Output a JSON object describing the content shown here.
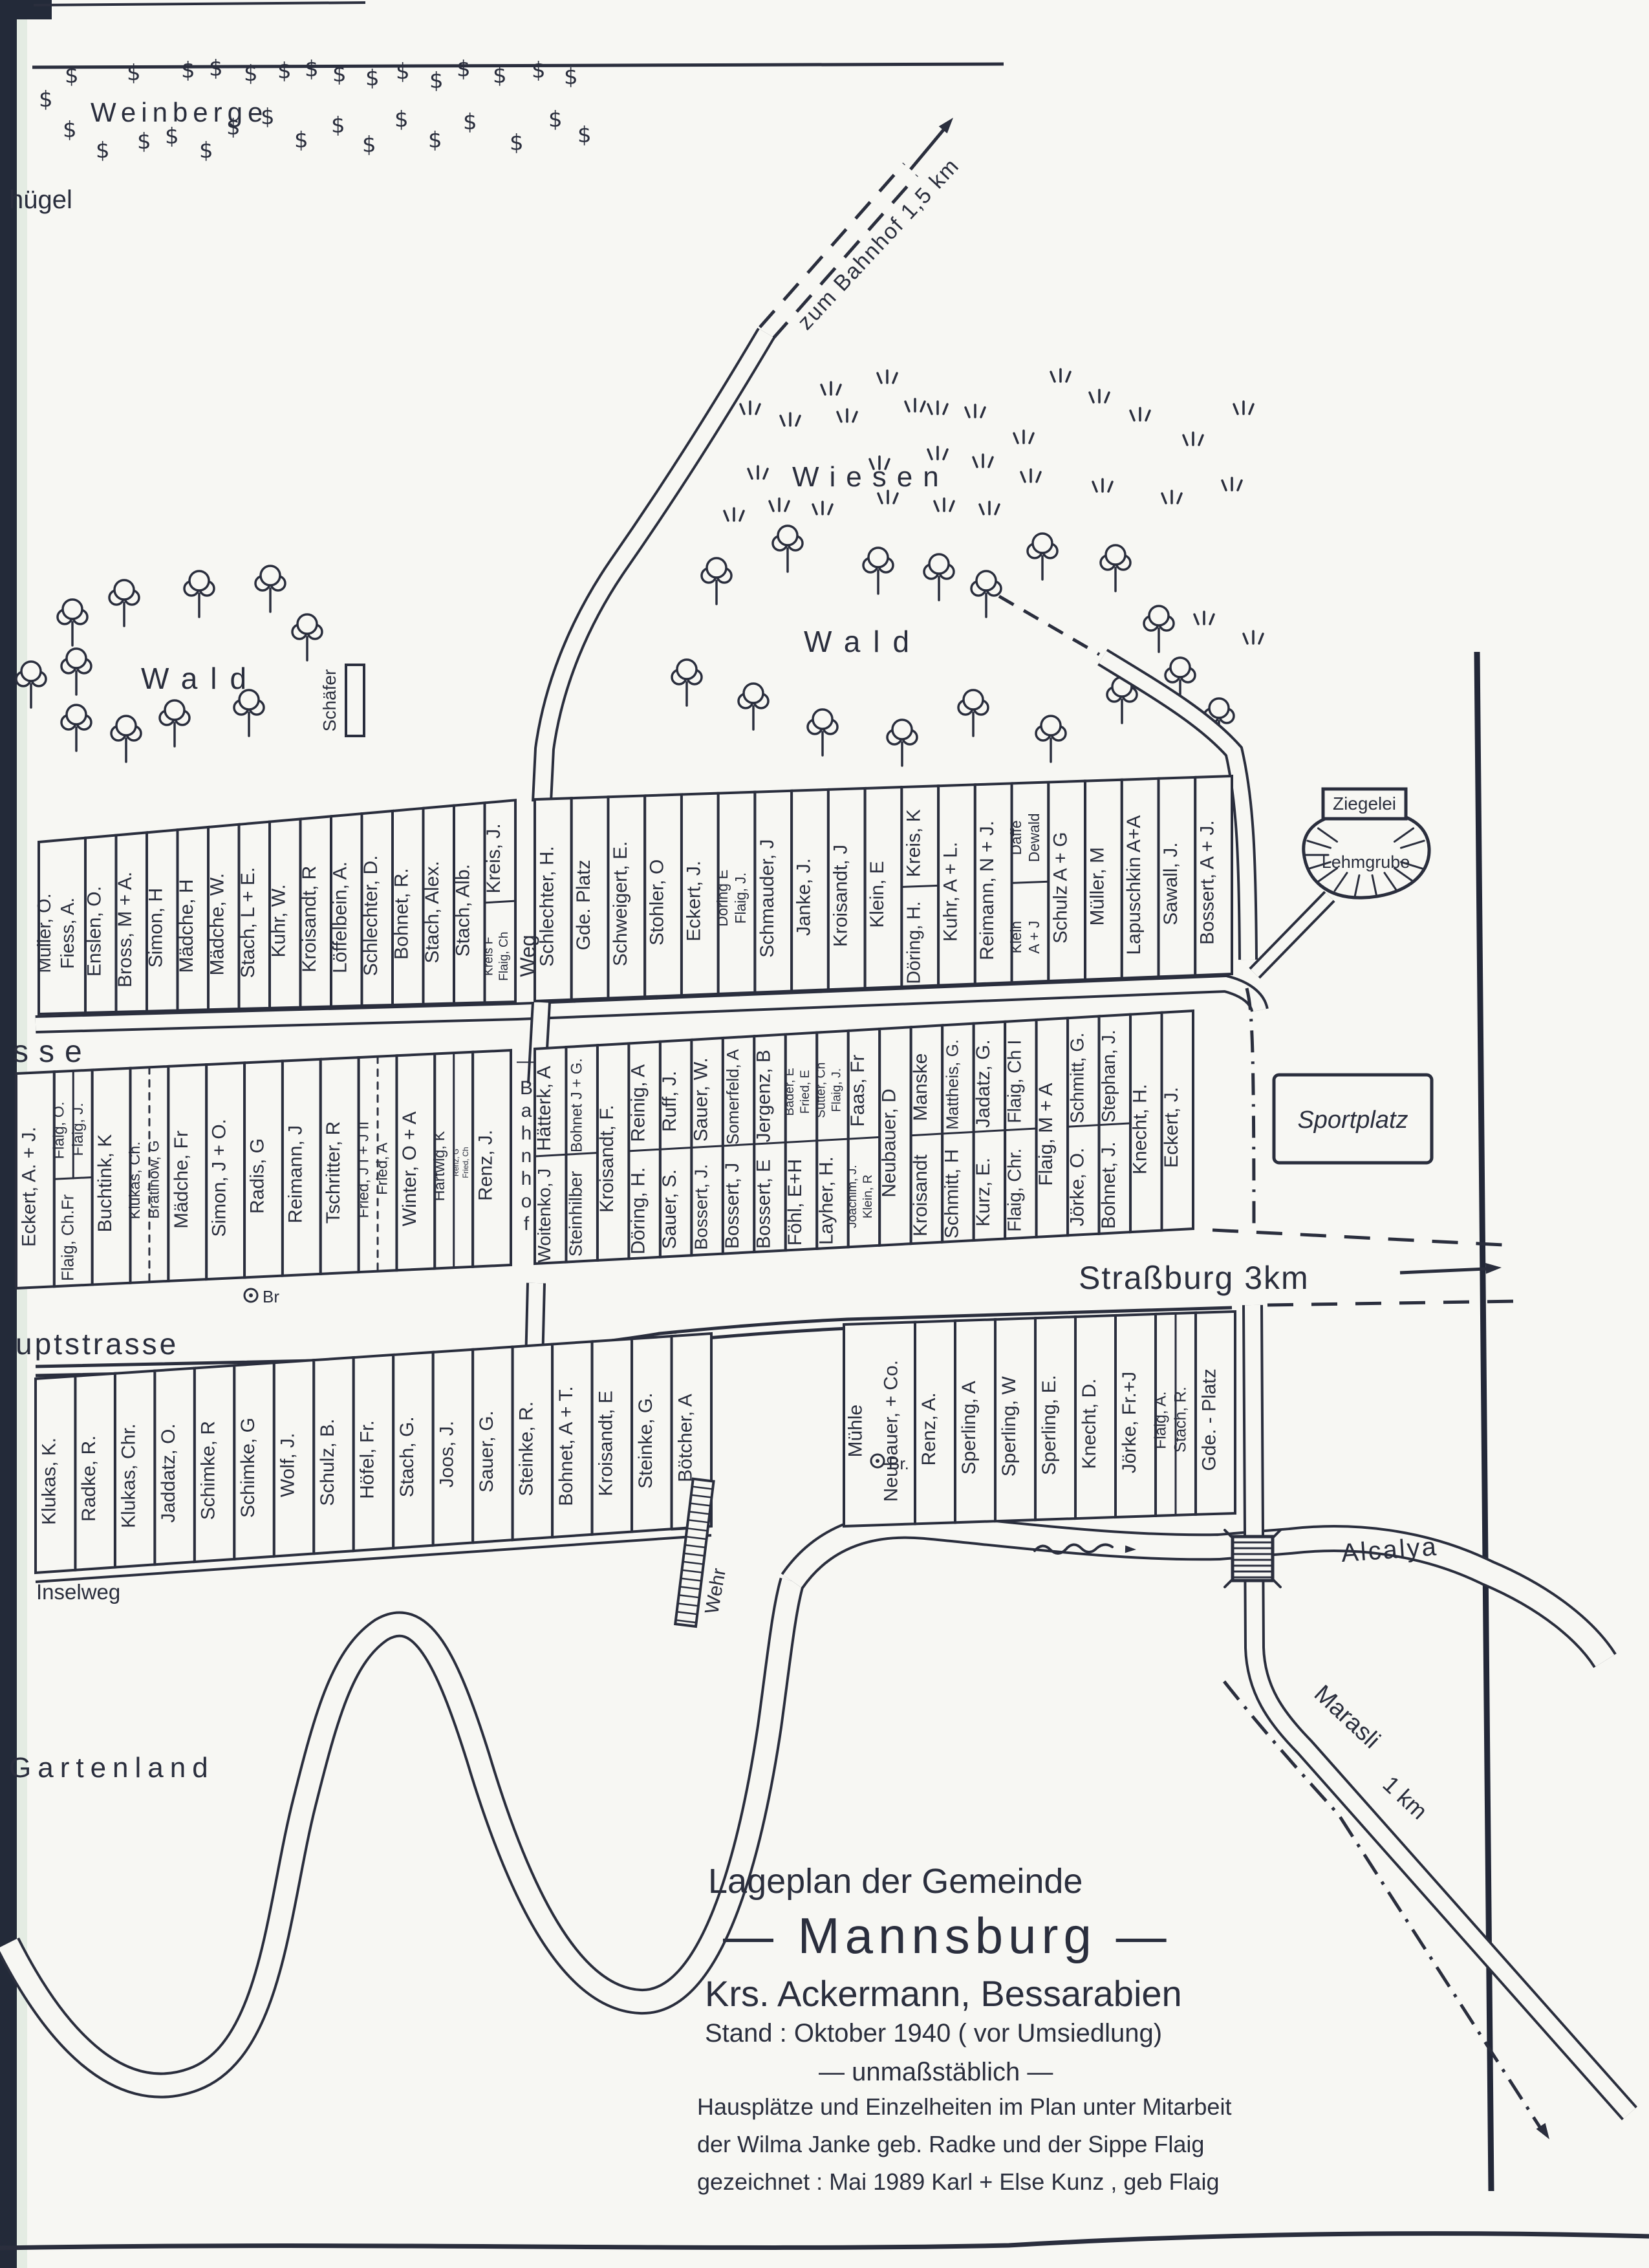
{
  "title_block": {
    "line1": "Lageplan der Gemeinde",
    "line2": "— Mannsburg —",
    "line3": "Krs. Ackermann, Bessarabien",
    "line4": "Stand : Oktober 1940 ( vor Umsiedlung)",
    "line5": "— unmaßstäblich —",
    "credit1": "Hausplätze und Einzelheiten im Plan unter Mitarbeit",
    "credit2": "der Wilma Janke geb. Radke und der Sippe Flaig",
    "credit3": "gezeichnet : Mai 1989   Karl + Else Kunz , geb Flaig"
  },
  "map_labels": {
    "weinberge": "Weinberge",
    "huegel": "hügel",
    "wiesen": "Wiesen",
    "wald_left": "Wald",
    "wald_right": "Wald",
    "weg": "Weg",
    "bahnhof_street": "Bahnhof",
    "strasse_fragment": "sse",
    "hauptstrasse_fragment": "uptstrasse",
    "inselweg": "Inselweg",
    "gartenland": "Gartenland",
    "schaefer": "Schäfer",
    "ziegelei": "Ziegelei",
    "lehmgrube": "Lehmgrube",
    "sportplatz": "Sportplatz",
    "wehr": "Wehr",
    "alcalya": "Alcalya",
    "zum_bahnhof": "zum Bahnhof  1,5 km",
    "strassburg": "Straßburg 3km",
    "marasli": "Marasli",
    "marasli_km": "1 km",
    "br1": "Br",
    "br2": "Br."
  },
  "rows": {
    "row1_left": [
      {
        "l": [
          "Müller, O.",
          "Fiess, A."
        ]
      },
      "Enslen, O.",
      "Bross, M + A.",
      "Simon, H",
      "Mädche, H",
      "Mädche, W.",
      "Stach, L + E.",
      "Kuhr, W.",
      "Kroisandt, R",
      "Löffelbein, A.",
      "Schlechter, D.",
      "Bohnet, R.",
      "Stach, Alex.",
      "Stach, Alb.",
      {
        "t": "Kreis, J.",
        "b": {
          "l": [
            "Kreis F",
            "Flaig, Ch"
          ]
        }
      }
    ],
    "row1_right": [
      "Schlechter, H.",
      "Gde. Platz",
      "Schweigert, E.",
      "Stohler, O",
      "Eckert, J.",
      {
        "l": [
          "Döring E",
          "Flaig, J."
        ]
      },
      "Schmauder, J",
      "Janke, J.",
      "Kroisandt, J",
      "Klein, E",
      {
        "t": "Kreis, K",
        "b": "Döring, H."
      },
      "Kuhr, A + L.",
      "Reimann, N + J.",
      {
        "t": {
          "l": [
            "Daffe",
            "Dewald"
          ]
        },
        "b": {
          "l": [
            "Klein",
            "A + J"
          ]
        }
      },
      "Schulz A + G",
      "Müller, M",
      "Lapuschkin A+A",
      "Sawall, J.",
      "Bossert, A + J."
    ],
    "row2_left": [
      "Eckert, A. + J.",
      {
        "t": {
          "p": [
            "Flaig, O.",
            "Flaig, J."
          ]
        },
        "b": "Flaig, Ch.Fr"
      },
      "Buchtink, K",
      {
        "p": [
          "Klukas, Ch.",
          "Bratinow, G"
        ],
        "d": 1
      },
      "Mädche, Fr",
      "Simon, J + O.",
      "Radis, G",
      "Reimann, J",
      "Tschritter, R",
      {
        "p": [
          "Fried, J I + J II",
          "Fried, A"
        ],
        "d": 1
      },
      "Winter, O + A",
      {
        "p": [
          "Hartwig, K",
          {
            "l": [
              "Renz, G",
              "Fried, Ch"
            ]
          }
        ]
      },
      "Renz, J."
    ],
    "row2_right": [
      {
        "t": "Hätterk, A",
        "b": "Woitenko, J"
      },
      {
        "t": "Bohnet J + G.",
        "b": "Steinhilber"
      },
      "Kroisandt, F.",
      {
        "t": "Reinig, A",
        "b": "Döring, H."
      },
      {
        "t": "Ruff, J.",
        "b": "Sauer, S."
      },
      {
        "t": "Sauer, W.",
        "b": "Bossert, J."
      },
      {
        "t": "Somerfeld, A",
        "b": "Bossert, J"
      },
      {
        "t": "Jergenz, B",
        "b": "Bossert, E"
      },
      {
        "t": {
          "l": [
            "Bader, E",
            "Fried, E"
          ]
        },
        "b": "Föhl, E+H"
      },
      {
        "t": {
          "l": [
            "Sutter, Ch",
            "Flaig, J."
          ]
        },
        "b": "Layher, H."
      },
      {
        "t": "Faas, Fr",
        "b": {
          "l": [
            "Joachim, J.",
            "Klein, R"
          ]
        }
      },
      "Neubauer, D",
      {
        "t": "Manske",
        "b": "Kroisandt"
      },
      {
        "t": "Mattheis, G.",
        "b": "Schmitt, H"
      },
      {
        "t": "Jadatz, G.",
        "b": "Kurz, E."
      },
      {
        "t": "Flaig, Ch I",
        "b": "Flaig, Chr."
      },
      "Flaig, M + A",
      {
        "t": "Schmitt, G.",
        "b": "Jörke, O."
      },
      {
        "t": "Stephan, J.",
        "b": "Bohnet, J."
      },
      "Knecht, H.",
      "Eckert, J."
    ],
    "row3": [
      "Klukas, K.",
      "Radke, R.",
      "Klukas, Chr.",
      "Jaddatz, O.",
      "Schimke, R",
      "Schimke, G",
      "Wolf, J.",
      "Schulz, B.",
      "Höfel, Fr.",
      "Stach, G.",
      "Joos, J.",
      "Sauer, G.",
      "Steinke, R.",
      "Bohnet, A + T.",
      "Kroisandt, E",
      "Steinke, G.",
      "Bötcher, A"
    ],
    "mill_row": [
      {
        "l": [
          "Mühle",
          "Neubauer, + Co."
        ]
      },
      "Renz, A.",
      "Sperling, A",
      "Sperling, W",
      "Sperling, E.",
      "Knecht, D.",
      "Jörke, Fr.+J",
      {
        "p": [
          "Flaig, A.",
          "Stach, R."
        ]
      },
      "Gde. - Platz"
    ]
  }
}
